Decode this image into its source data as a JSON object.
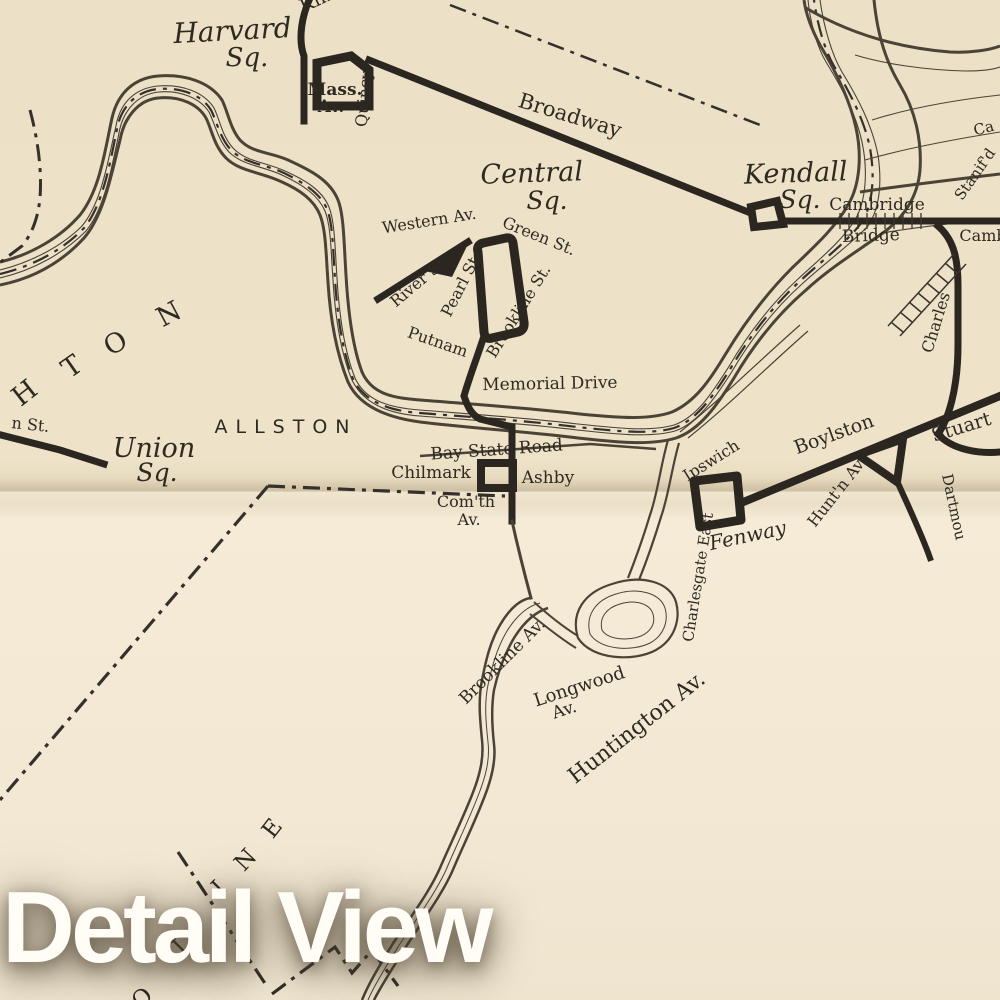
{
  "overlay": {
    "title": "Detail View"
  },
  "colors": {
    "paper": "#efe4cc",
    "ink": "#2e2a22",
    "route": "#2b2620",
    "overlay_text": "#fffdf6"
  },
  "labels": {
    "kin_partial": "Kin",
    "harvard": "Harvard",
    "harvard_sq": "Sq.",
    "mass": "Mass.",
    "mass_av": "Av.",
    "quincy": "Quincy",
    "broadway": "Broadway",
    "central": "Central",
    "central_sq": "Sq.",
    "kendall": "Kendall",
    "kendall_sq": "Sq.",
    "cambridge": "Cambridge",
    "bridge": "Bridge",
    "stanifd": "Stanif'd",
    "ca_partial": "Ca",
    "camb_partial": "Camb",
    "western_av": "Western Av.",
    "green_st": "Green St.",
    "river_st": "River St.",
    "pearl_st": "Pearl St.",
    "brookline_st": "Brookline St.",
    "putnam": "Putnam",
    "memorial_drive": "Memorial Drive",
    "allston": "ALLSTON",
    "n_st_partial": "n St.",
    "union": "Union",
    "union_sq": "Sq.",
    "brighton_h": "H",
    "brighton_t": "T",
    "brighton_o": "O",
    "brighton_n": "N",
    "bay_state_road": "Bay State Road",
    "chilmark": "Chilmark",
    "ashby": "Ashby",
    "comth": "Com'th",
    "comth_av": "Av.",
    "ipswich": "Ipswich",
    "fenway": "Fenway",
    "charlesgate_east": "Charlesgate East",
    "boylston": "Boylston",
    "huntn_av": "Hunt'n Av.",
    "stuart": "Stuart",
    "dartmou_partial": "Dartmou",
    "charles": "Charles",
    "brookline_av": "Brookline Av.",
    "longwood": "Longwood",
    "longwood_av": "Av.",
    "huntington_av": "Huntington Av.",
    "brookline_o": "O",
    "brookline_l": "L",
    "brookline_i": "I",
    "brookline_n": "N",
    "brookline_e": "E"
  }
}
